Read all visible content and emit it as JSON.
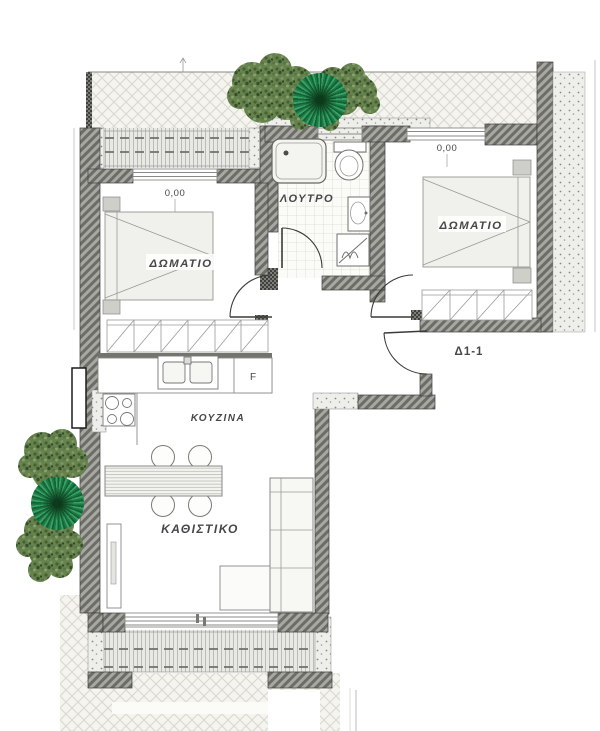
{
  "unit_label": "Δ1-1",
  "rooms": {
    "bathroom": {
      "label": "ΛΟΥΤΡΟ"
    },
    "bedroom_left": {
      "label": "ΔΩΜΑΤΙΟ",
      "level": "0,00"
    },
    "bedroom_right": {
      "label": "ΔΩΜΑΤΙΟ",
      "level": "0,00"
    },
    "kitchen": {
      "label": "ΚΟΥΖΙΝΑ",
      "fridge_label": "F"
    },
    "living_room": {
      "label": "ΚΑΘΙΣΤΙΚΟ"
    }
  },
  "icons": {
    "trees": "foliage-tree-icon",
    "palms": "palm-starburst-icon",
    "shower": "shower-tray-icon",
    "toilet": "toilet-icon",
    "washbasin": "washbasin-icon",
    "water_heater": "water-heater-icon",
    "stove": "stove-burners-icon",
    "sink": "double-sink-icon"
  },
  "colors": {
    "foliage_green": "#66824f",
    "palm_green": "#1d7a46",
    "wall_gray": "#8a8a86",
    "hatch_line": "#d8d7cf",
    "label_gray": "#47474a",
    "unit_label_gray": "#72726e"
  }
}
